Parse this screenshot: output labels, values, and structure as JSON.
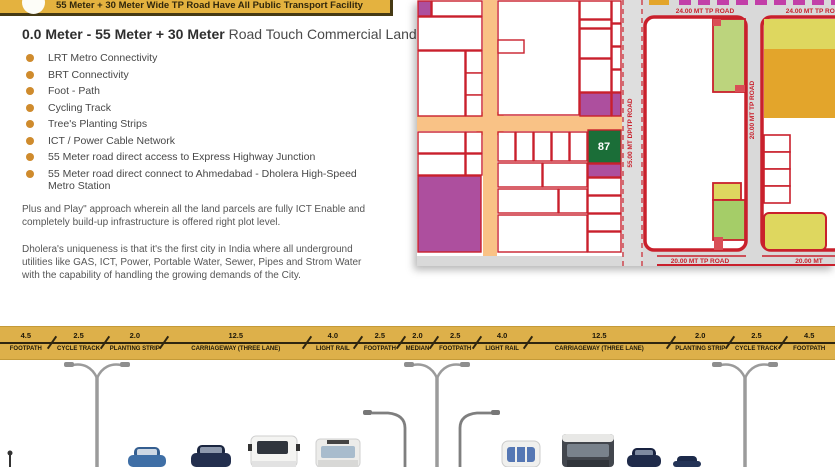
{
  "banner": {
    "text": "55 Meter + 30 Meter Wide  TP Road Have All Public Transport Facility"
  },
  "heading": {
    "bold": "0.0 Meter  -  55 Meter + 30 Meter",
    "regular": " Road Touch Commercial Land"
  },
  "features": [
    "LRT Metro Connectivity",
    "BRT Connectivity",
    "Foot - Path",
    "Cycling Track",
    "Tree's Planting Strips",
    "ICT / Power Cable Network",
    "55 Meter road direct access to Express Highway Junction",
    "55 Meter road direct connect to Ahmedabad - Dholera High-Speed Metro Station"
  ],
  "paragraphs": {
    "p1": "Plus and Play\" approach wherein all the land parcels are fully ICT Enable and completely build-up infrastructure is offered right plot level.",
    "p2": "Dholera's uniqueness is that it's the first city in India where all underground utilities like GAS, ICT, Power, Portable Water, Sewer, Pipes and Strom Water with the capability of handling the growing demands of the City."
  },
  "map": {
    "plot_number": "87",
    "labels": {
      "road_55mt": "55.00 MT DP/TP ROAD",
      "road_24mt_left": "24.00 MT TP ROAD",
      "road_24mt_right": "24.00 MT TP ROAD",
      "road_20mt_vertical": "20.00 MT TP ROAD",
      "road_20mt_bottom": "20.00 MT TP ROAD",
      "road_20mt_bottom_right": "20.00 MT"
    },
    "colors": {
      "road_fill": "#f9c286",
      "parcel_border": "#c9202c",
      "purple_parcel": "#ad4f9e",
      "highlight_parcel": "#1b6e38",
      "green_parcel": "#bcd47d",
      "yellow_parcel": "#ded75f",
      "orange_parcel": "#e3a52b",
      "backdrop": "#d9d9d9"
    }
  },
  "cross_section": {
    "type": "road-cross-section",
    "units": "meters",
    "total_label": "55 Meter + 30 Meter wide TP road",
    "segments": [
      {
        "value": "4.5",
        "label": "FOOTPATH"
      },
      {
        "value": "2.5",
        "label": "CYCLE TRACK"
      },
      {
        "value": "2.0",
        "label": "PLANTING STRIP"
      },
      {
        "value": "12.5",
        "label": "CARRIAGEWAY (THREE LANE)"
      },
      {
        "value": "4.0",
        "label": "LIGHT RAIL"
      },
      {
        "value": "2.5",
        "label": "FOOTPATH"
      },
      {
        "value": "2.0",
        "label": "MEDIAN"
      },
      {
        "value": "2.5",
        "label": "FOOTPATH"
      },
      {
        "value": "4.0",
        "label": "LIGHT RAIL"
      },
      {
        "value": "12.5",
        "label": "CARRIAGEWAY (THREE LANE)"
      },
      {
        "value": "2.0",
        "label": "PLANTING STRIP"
      },
      {
        "value": "2.5",
        "label": "CYCLE TRACK"
      },
      {
        "value": "4.5",
        "label": "FOOTPATH"
      }
    ],
    "bar_color": "#ddb04a"
  },
  "colors": {
    "banner_bg": "#e4b23f",
    "banner_text": "#31270c",
    "bullet": "#cf8b2d",
    "body_text": "#474747"
  }
}
